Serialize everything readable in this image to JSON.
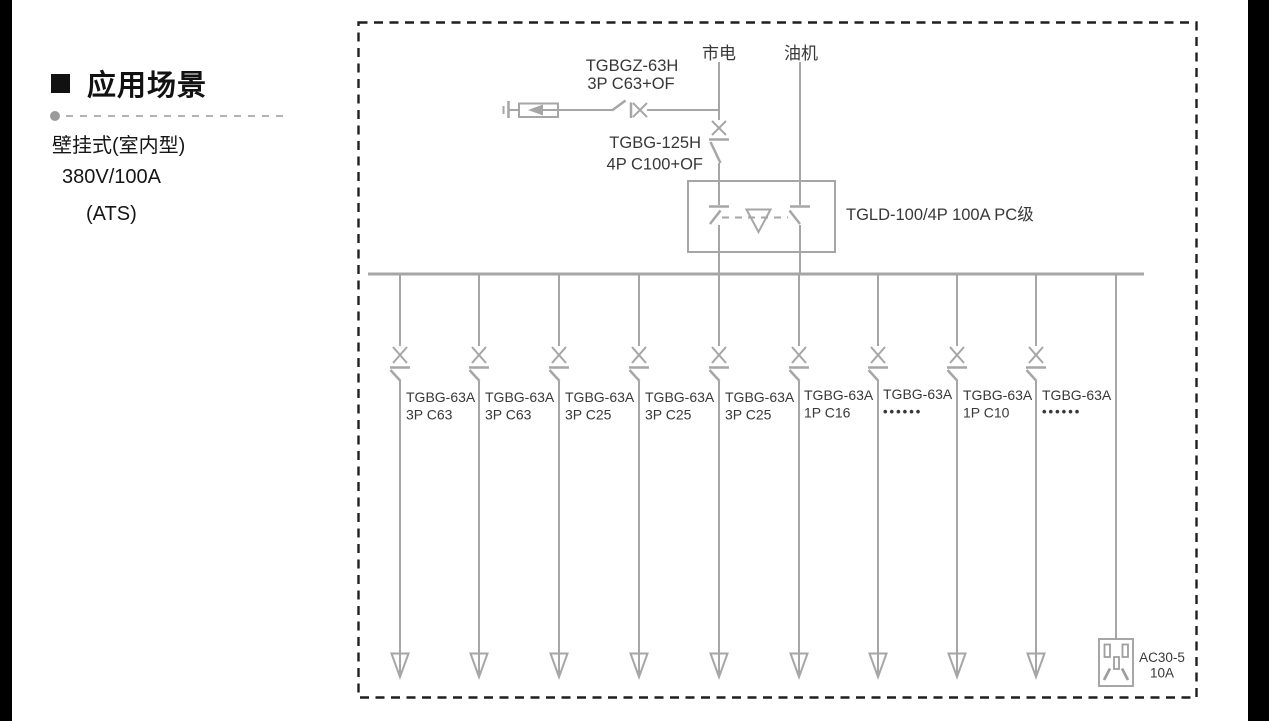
{
  "sidebar": {
    "heading": "应用场景",
    "lines": [
      "壁挂式(室内型)",
      "380V/100A",
      "(ATS)"
    ]
  },
  "diagram": {
    "colors": {
      "line_gray": "#a6a6a6",
      "text_gray": "#383838",
      "border_black": "#1f1f1f",
      "sidebar_black": "#000000"
    },
    "sources": {
      "mains": "市电",
      "generator": "油机"
    },
    "spd_breaker": {
      "model": "TGBGZ-63H",
      "spec": "3P C63+OF"
    },
    "main_breaker": {
      "model": "TGBG-125H",
      "spec": "4P C100+OF"
    },
    "ats": {
      "label": "TGLD-100/4P 100A PC级"
    },
    "branches": [
      {
        "model": "TGBG-63A",
        "spec": "3P C63"
      },
      {
        "model": "TGBG-63A",
        "spec": "3P C63"
      },
      {
        "model": "TGBG-63A",
        "spec": "3P C25"
      },
      {
        "model": "TGBG-63A",
        "spec": "3P C25"
      },
      {
        "model": "TGBG-63A",
        "spec": "3P C25"
      },
      {
        "model": "TGBG-63A",
        "spec": "1P C16"
      },
      {
        "model": "TGBG-63A",
        "spec": "••••••"
      },
      {
        "model": "TGBG-63A",
        "spec": "1P C10"
      },
      {
        "model": "TGBG-63A",
        "spec": "••••••"
      }
    ],
    "socket": {
      "model": "AC30-5",
      "rating": "10A"
    }
  }
}
